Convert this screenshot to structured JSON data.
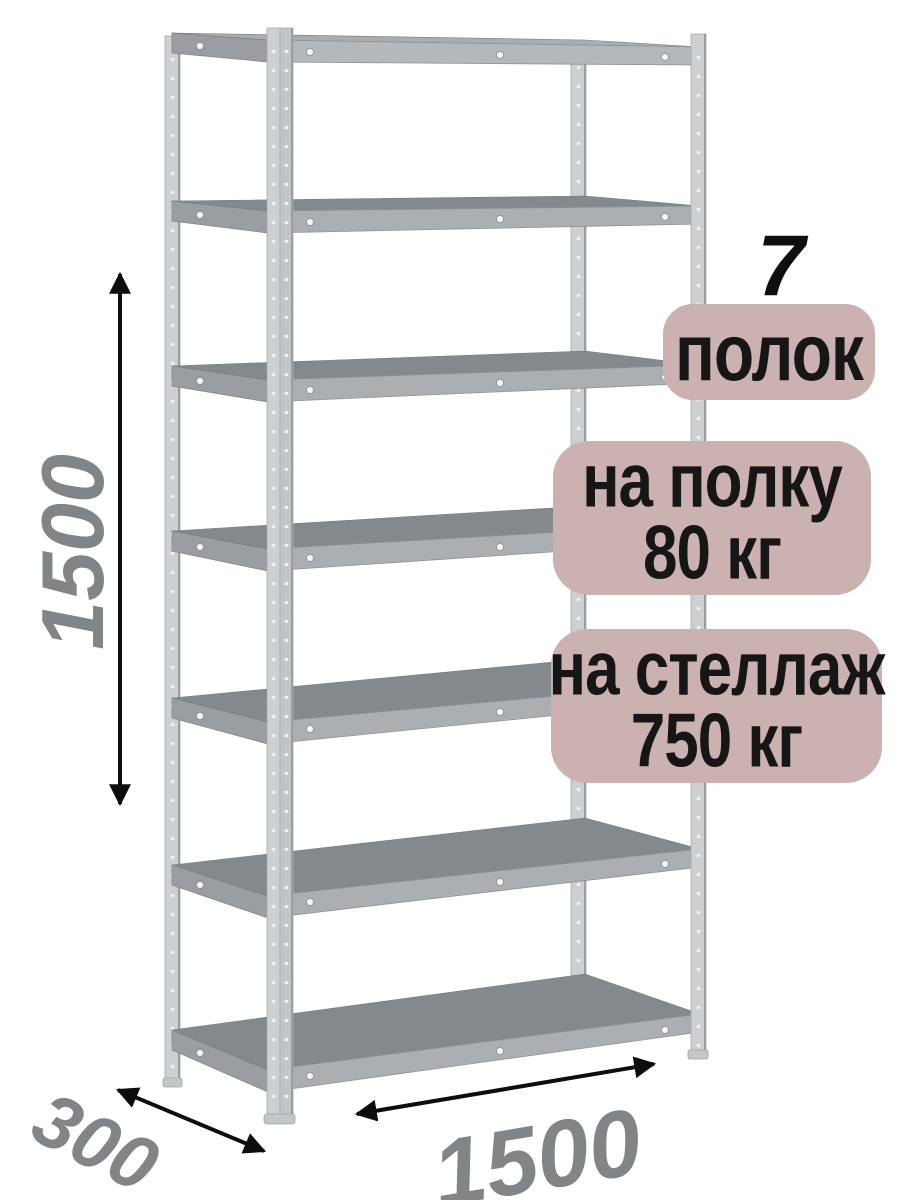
{
  "badges": {
    "count": {
      "number": "7",
      "label": "полок"
    },
    "per_shelf": {
      "line1": "на полку",
      "line2": "80 кг"
    },
    "per_rack": {
      "line1": "на стеллаж",
      "line2": "750 кг"
    }
  },
  "dimensions": {
    "height": "1500",
    "depth": "300",
    "width": "1500"
  },
  "illustration": {
    "subject": "metal shelving rack, 3D view",
    "shelf_count": 7,
    "post_count": 4
  },
  "colors": {
    "background": "#ffffff",
    "badge_background": "#cbb1b0",
    "badge_text": "#161616",
    "dimension_text": "#828588",
    "arrow": "#0d0d0d",
    "shelf_top": "#84898d",
    "shelf_front": "#abafb2",
    "post": "#ccd0d3"
  }
}
